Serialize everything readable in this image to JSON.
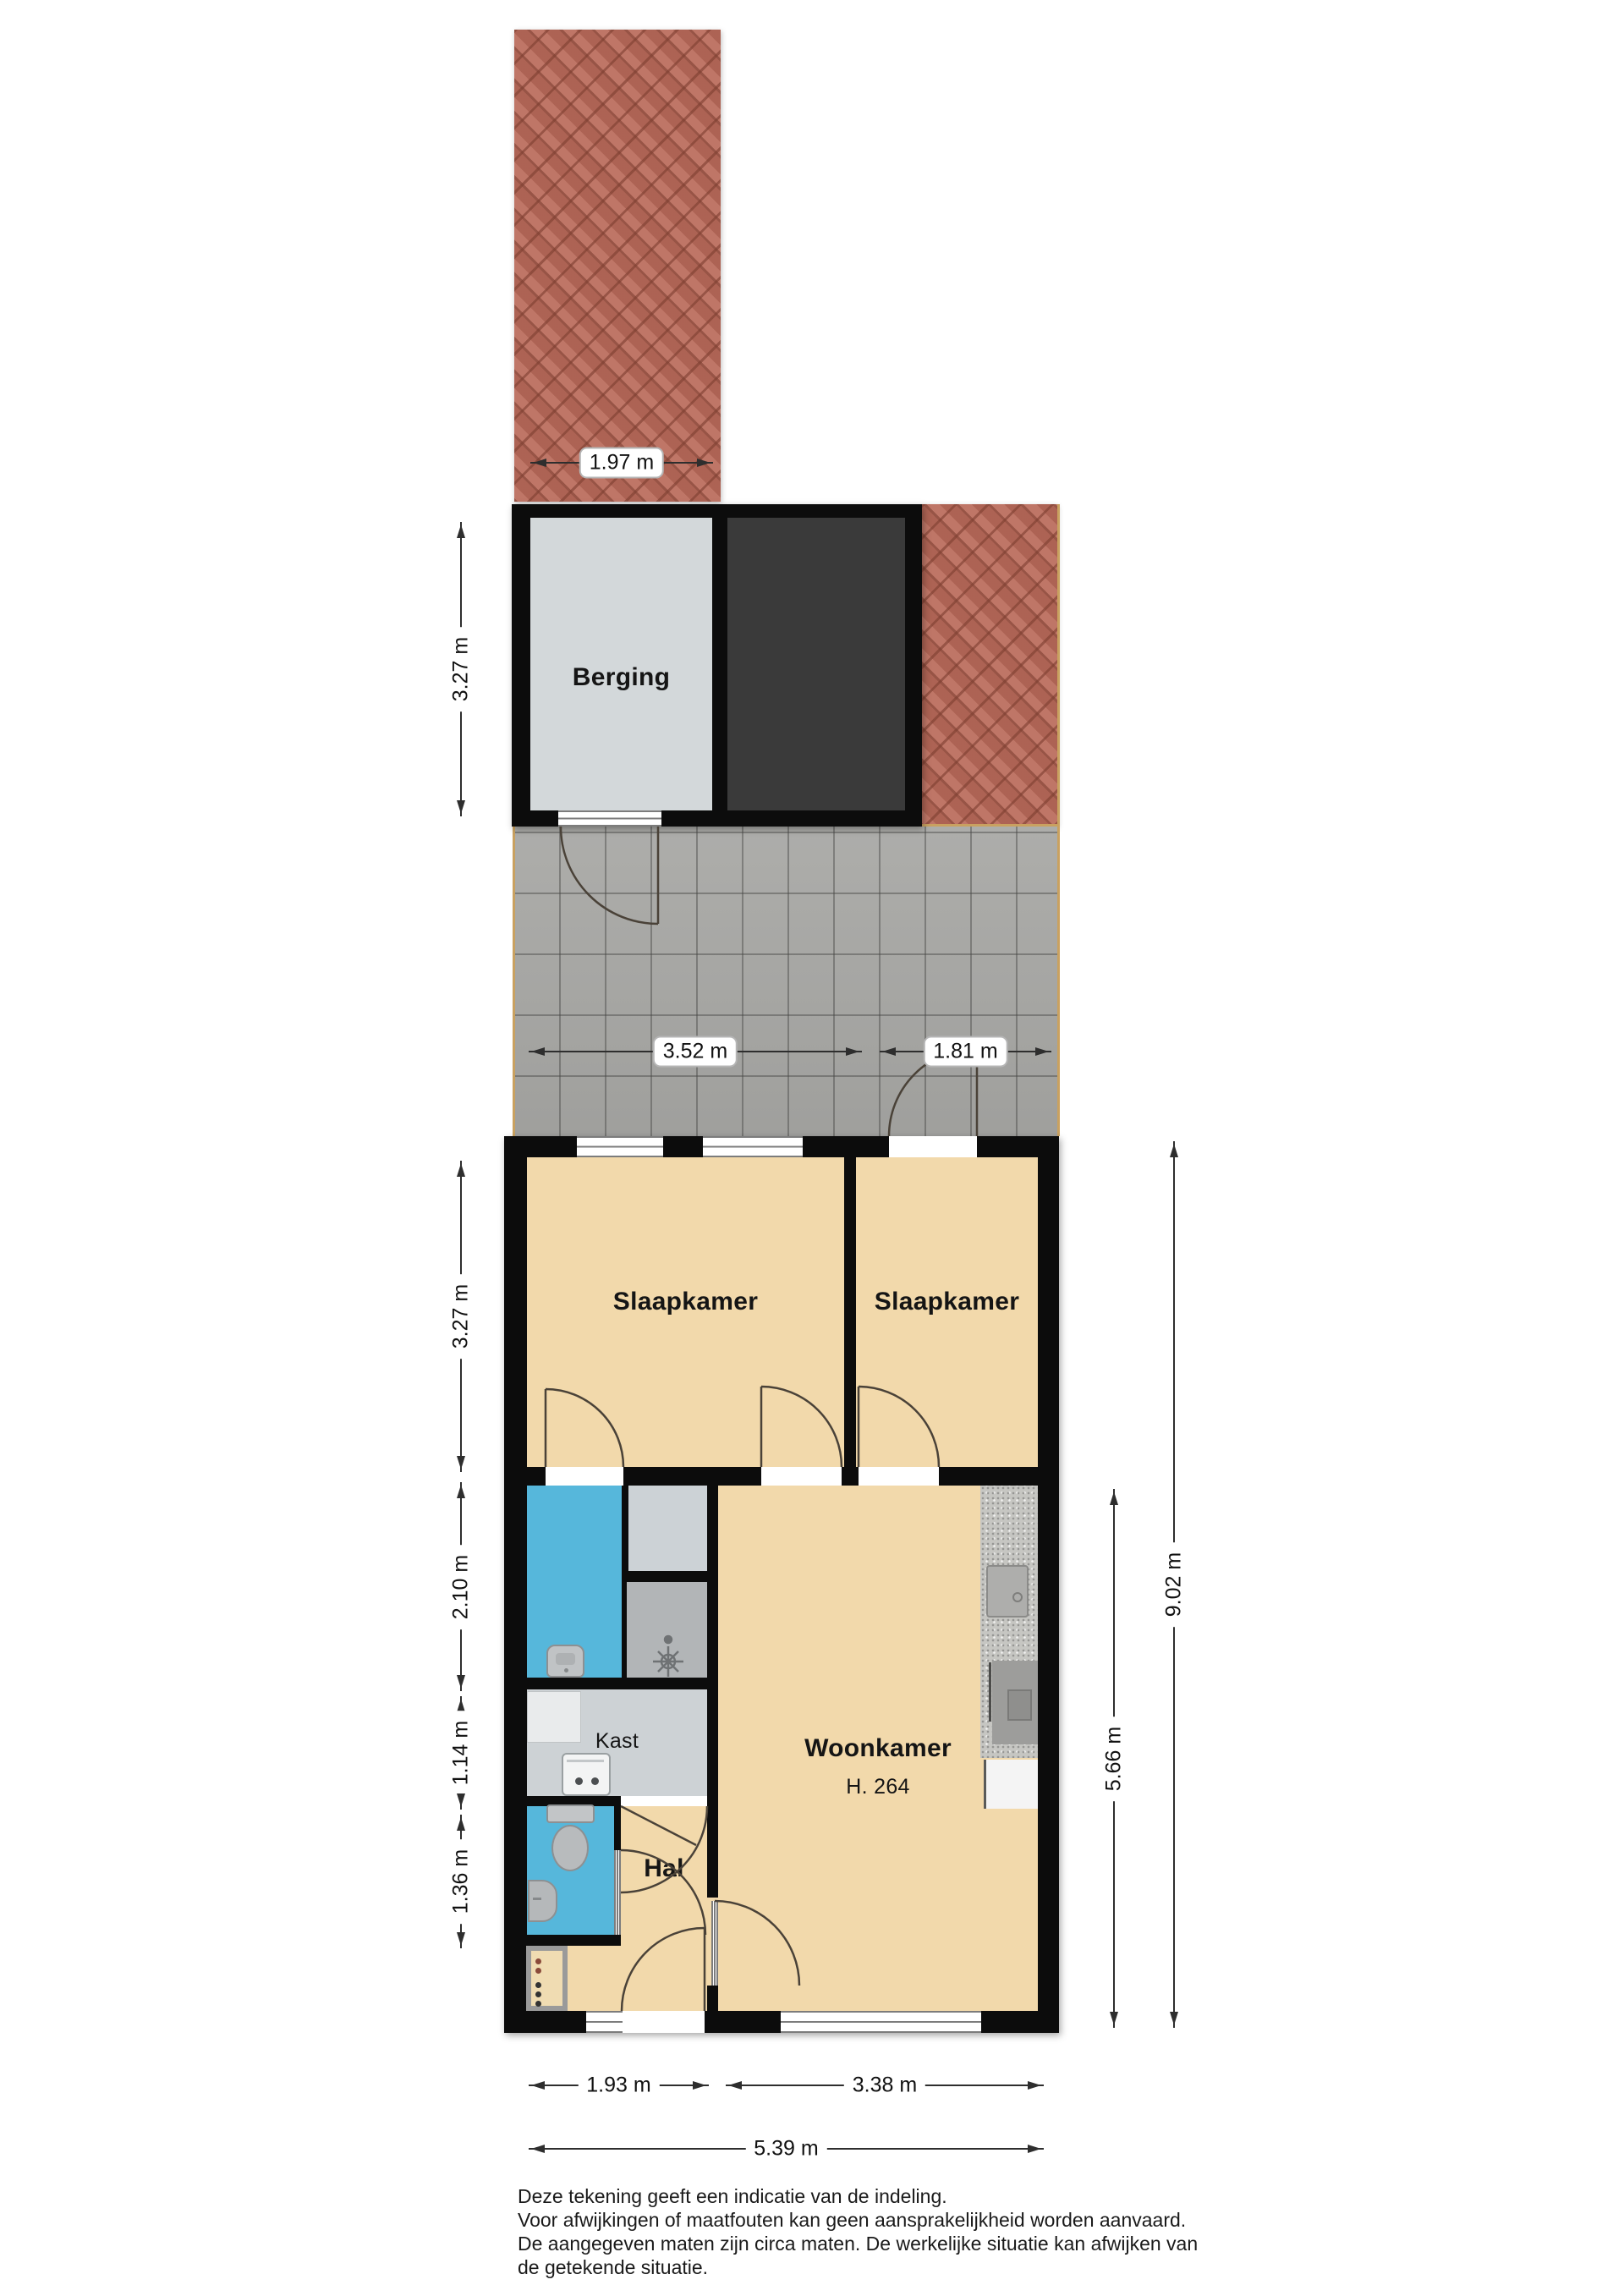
{
  "rooms": {
    "berging": "Berging",
    "bedroom_left": "Slaapkamer",
    "bedroom_right": "Slaapkamer",
    "living": "Woonkamer",
    "living_ceiling_height": "H. 264",
    "closet": "Kast",
    "hall": "Hal"
  },
  "dimensions": {
    "shed_path_width": "1.97 m",
    "garden_width_left": "3.52 m",
    "garden_width_right": "1.81 m",
    "shed_height": "3.27 m",
    "bedrooms_depth": "3.27 m",
    "bathroom_depth": "2.10 m",
    "closet_depth": "1.14 m",
    "hall_depth": "1.36 m",
    "house_depth_total": "9.02 m",
    "living_depth": "5.66 m",
    "front_left_width": "1.93 m",
    "front_right_width": "3.38 m",
    "front_total_width": "5.39 m"
  },
  "disclaimer": [
    "Deze tekening geeft een indicatie van de indeling.",
    "Voor  afwijkingen of maatfouten kan geen aansprakelijkheid worden aanvaard.",
    "De aangegeven maten zijn circa maten. De werkelijke situatie kan afwijken van",
    "de getekende situatie."
  ],
  "fixtures": {
    "toilet_icon": "toilet plan symbol",
    "wc_sink_icon": "small hand basin",
    "bath_sink_icon": "washbasin",
    "shower_icon": "shower drain symbol",
    "kitchen_sink_icon": "kitchen sink",
    "stove_icon": "cooktop",
    "boiler_icon": "boiler / appliance",
    "meter_panel_icon": "meter cupboard panel"
  },
  "colors": {
    "wall": "#0c0c0c",
    "floor_beige": "#f2d9ab",
    "water_blue": "#56b7db",
    "berging_floor": "#d3d8da",
    "dark_storage": "#3a3a3a",
    "patio_tile": "#a8a8a5",
    "brick": "#b4695b",
    "border_tan": "#c9a160",
    "kitchen_counter": "#c6c6c2"
  }
}
